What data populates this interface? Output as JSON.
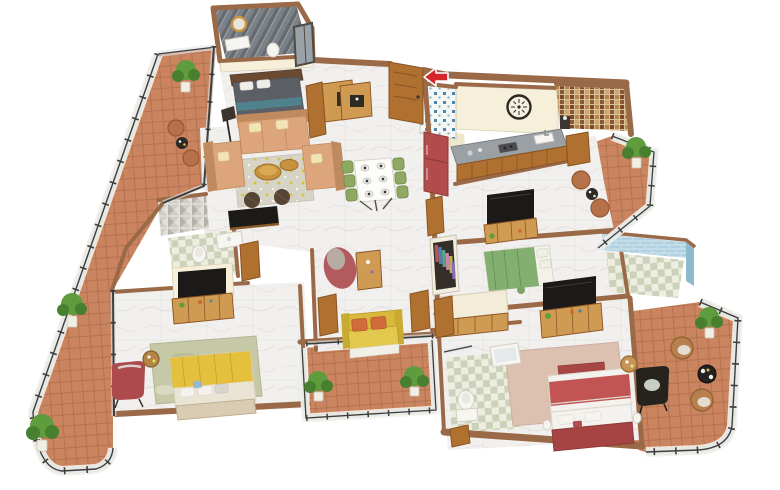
{
  "scene": {
    "type": "isometric-3d-floor-plan",
    "description_semantic": "3d-rendered-apartment-floor-plan-no-text-labels",
    "background": "#ffffff",
    "marker": {
      "name": "entrance-arrow",
      "shape": "left-pointing-arrow",
      "color": "#d3262a"
    },
    "rooms": [
      {
        "name": "shower-bathroom-top",
        "floor": "dark-gray-striped-tile",
        "items": [
          "gold-round-mirror",
          "white-vanity",
          "toilet",
          "window"
        ]
      },
      {
        "name": "bedroom-gray",
        "floor": "white-marble",
        "items": [
          "gray-double-bed",
          "wood-headboard",
          "wall-desk-unit",
          "floor-lamp"
        ]
      },
      {
        "name": "living-room",
        "floor": "white-marble",
        "items": [
          "three-seat-sofa",
          "armchair-left",
          "armchair-right",
          "dotted-rug",
          "two-gold-coffee-tables",
          "two-brown-poufs",
          "tv-console"
        ]
      },
      {
        "name": "dining-area",
        "floor": "white-marble",
        "items": [
          "white-dining-table",
          "six-green-chairs",
          "six-place-settings"
        ]
      },
      {
        "name": "foyer",
        "floor": "white-marble",
        "items": [
          "entrance-door",
          "open-door",
          "shoe-cabinet",
          "blue-mosaic-accent-wall",
          "entrance-arrow"
        ]
      },
      {
        "name": "kitchen",
        "floor": "beige-tile",
        "items": [
          "red-refrigerator",
          "galley-counter",
          "sink",
          "stove",
          "wall-clock"
        ]
      },
      {
        "name": "bathroom-mosaic-right",
        "floor": "tile",
        "items": [
          "brown-mosaic-accent-wall",
          "dark-wash-basin",
          "wood-door"
        ]
      },
      {
        "name": "media-room",
        "floor": "white-marble",
        "items": [
          "wall-tv",
          "wood-console"
        ]
      },
      {
        "name": "dressing-corner",
        "floor": "white-marble",
        "items": [
          "open-wardrobe-with-clothes",
          "study-desk"
        ]
      },
      {
        "name": "bedroom-green",
        "floor": "white-marble",
        "items": [
          "green-double-bed",
          "round-cushion"
        ]
      },
      {
        "name": "bathroom-blue",
        "floor": "pale-checker-tile",
        "items": [
          "light-blue-mosaic-walls"
        ]
      },
      {
        "name": "master-bedroom",
        "floor": "white-marble",
        "items": [
          "red-double-bed",
          "pink-rug",
          "black-armchair",
          "round-side-table",
          "wall-tv",
          "wood-dresser",
          "foot-bench"
        ]
      },
      {
        "name": "bathroom-bottom",
        "floor": "checker-tile",
        "items": [
          "toilet",
          "bathtub",
          "shower-glass",
          "wood-door"
        ]
      },
      {
        "name": "bedroom-yellow",
        "floor": "white-marble",
        "items": [
          "yellow-double-bed",
          "sage-rug",
          "red-armchair",
          "round-side-table",
          "wall-tv",
          "wood-dresser"
        ]
      },
      {
        "name": "bathroom-mid-left",
        "floor": "checker-tile",
        "items": [
          "gray-3d-tile-wall",
          "toilet",
          "white-vanity",
          "wood-door"
        ]
      },
      {
        "name": "hallway",
        "floor": "white-marble",
        "items": [
          "yellow-bench-two-orange-cushions",
          "red-bean-bag",
          "wood-side-table"
        ]
      },
      {
        "name": "balcony-upper-left",
        "floor": "terracotta-tile",
        "items": [
          "potted-plant",
          "two-clay-chairs",
          "black-patio-table",
          "glass-railing"
        ]
      },
      {
        "name": "balcony-left-wrap",
        "floor": "terracotta-tile",
        "items": [
          "potted-plant",
          "potted-plant",
          "glass-railing-curved-end"
        ]
      },
      {
        "name": "balcony-center-bottom",
        "floor": "terracotta-tile",
        "items": [
          "potted-plant",
          "potted-plant",
          "glass-railing"
        ]
      },
      {
        "name": "balcony-right",
        "floor": "terracotta-tile",
        "items": [
          "potted-plant",
          "two-clay-chairs",
          "patio-table",
          "glass-railing"
        ]
      },
      {
        "name": "balcony-bottom-right",
        "floor": "terracotta-tile",
        "items": [
          "potted-plant",
          "two-rattan-chairs",
          "black-patio-table",
          "glass-railing-curved-end"
        ]
      }
    ]
  },
  "palette": {
    "bg": "#ffffff",
    "wallCap": "#9a6a48",
    "wallFace": "#f6f0da",
    "wallEdge": "#d9d0b4",
    "wood": "#b0702f",
    "woodDark": "#8a5423",
    "woodLight": "#cf9a52",
    "terracotta": "#ca8560",
    "terracottaLine": "#b06e4c",
    "marble": "#f1f0ee",
    "marbleVein": "#dedbd6",
    "kitchenFloor": "#efe7cc",
    "sofaTan": "#dca57c",
    "sofaTanDark": "#c08a5f",
    "pillowCream": "#f2e4b6",
    "rugGray": "#d6d3c7",
    "rugDotYellow": "#d9c33f",
    "rugSage": "#c6c9a7",
    "rugMasterPink": "#dcc0b0",
    "goldTable": "#c8913e",
    "poufBrown": "#564434",
    "bedGray": "#5c6066",
    "bedGreen": "#83b070",
    "bedYellow": "#e5c03d",
    "bedRedBlanket": "#c25553",
    "bedRedFrame": "#a64444",
    "chairRed": "#ad4a4e",
    "beanbagRed": "#b25a5e",
    "benchYellow": "#d9b83c",
    "cushionOrange": "#d06c3c",
    "chairBlack": "#26231f",
    "rattan": "#b8804e",
    "clay": "#b5714a",
    "chairGreen": "#8fa963",
    "fridgeRed": "#b24c4c",
    "counterGray": "#9aa0a4",
    "tvBlack": "#1c1a19",
    "plantGreen": "#5f9c3e",
    "plantGreenDark": "#47802e",
    "potWhite": "#f1eee4",
    "glassBlue": "#dfe9ec",
    "railFrame": "#3f3d3a",
    "curb": "#f4f1e8",
    "porcelain": "#f6f5f0",
    "checkerA": "#eeeee0",
    "checkerB": "#ccd2ba",
    "showerA": "#666b70",
    "showerB": "#7b8186",
    "mosaicBrownBase": "#d9c099",
    "mosaicBlueDot": "#4d86ad",
    "bathWallBlue": "#aed0e0",
    "clock": "#2e2a22",
    "mirrorGold": "#c8963f",
    "arrowRed": "#d3262a"
  }
}
